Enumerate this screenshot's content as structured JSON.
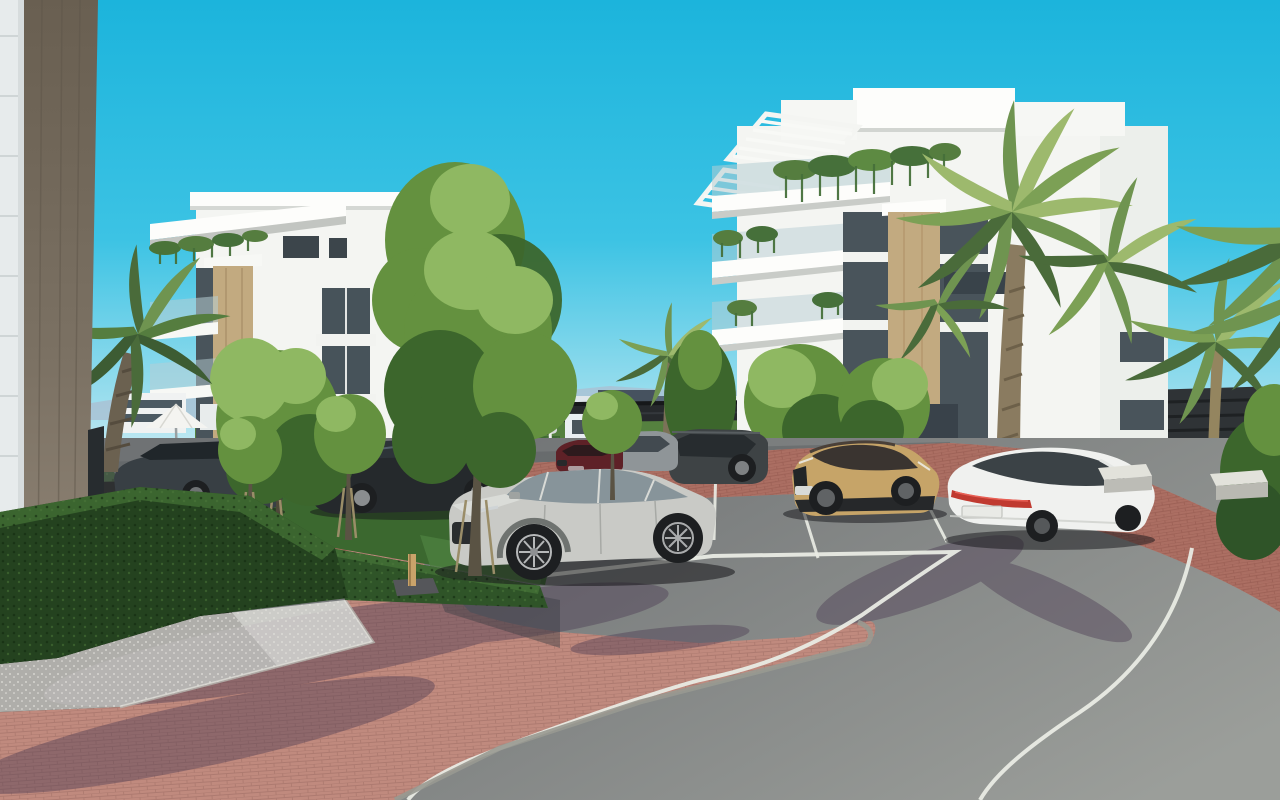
{
  "meta": {
    "type": "3d-architectural-render",
    "subject": "Modern white apartment complex with landscaped parking area, palm trees and curving access road under a clear cyan sky"
  },
  "palette": {
    "sky_top": "#1cb4dc",
    "sky_upper": "#3cc3e4",
    "sky_pale": "#9fdfee",
    "sky_horizon": "#dcf1f6",
    "mountain": "#a9c2d3",
    "town_white": "#e9eef1",
    "town_dark": "#46525f",
    "town_beige": "#cfc6b2",
    "fence": "#26292c",
    "wall_panel": "#e7ebec",
    "wall_brown": "#7a7063",
    "building_white": "#f4f5f2",
    "building_shade": "#e3e6e2",
    "cladding_tan": "#c2aa80",
    "glass_dark": "#49545b",
    "balustrade_glass": "#b7cdd3",
    "leaf_light": "#8fb862",
    "leaf_mid": "#64913f",
    "leaf_dark": "#3c662c",
    "palm_light": "#9db96d",
    "palm_mid": "#6f9450",
    "palm_dark": "#4a6b3a",
    "palm_trunk": "#8a7b60",
    "hedge_dark": "#24421f",
    "hedge_mid": "#2f5428",
    "hedge_light": "#3f6b33",
    "lawn": "#3b682f",
    "grass_sun": "#679553",
    "asphalt_dark": "#6f7274",
    "asphalt_light": "#9b9e9a",
    "paver_plaza": "#c08a7e",
    "paver_walkway": "#a86a5e",
    "gravel": "#e9e8e3",
    "marking_white": "#e9ebe4",
    "curb_grey": "#989991",
    "car_silver": "#c9cac6",
    "car_black": "#25292c",
    "car_estate_grey": "#383f44",
    "car_red": "#5e2127",
    "car_grey_suv": "#8f9598",
    "car_dark_suv": "#3e4345",
    "car_gold": "#c6a468",
    "car_white": "#f0f1ef",
    "car_distant": "#d8dbdb",
    "taillight_red": "#c03a30",
    "wheel_dark": "#1d1f21",
    "stake_wood": "#c9a36a",
    "umbrella_white": "#f4f4f1",
    "bench_concrete": "#e2e2db"
  },
  "scene": {
    "buildings": [
      {
        "id": "left-apartment-building",
        "floors": 4,
        "style": "white modern with tan cladding strip, cantilevered roof terrace and hanging plants"
      },
      {
        "id": "right-apartment-building",
        "floors": 4,
        "style": "white modern with rooftop pergolas, glass balconies, trailing greenery and tan cladding strip"
      },
      {
        "id": "foreground-wall",
        "style": "brown concrete column and white panel wall at left edge"
      },
      {
        "id": "distant-town",
        "style": "low white and dark buildings beyond perimeter fence with mountains on horizon"
      }
    ],
    "vehicles": [
      {
        "id": "silver-suv",
        "position": "center foreground parking stall"
      },
      {
        "id": "black-estate",
        "position": "behind trees, left row"
      },
      {
        "id": "dark-grey-estate",
        "position": "far left behind hedge"
      },
      {
        "id": "dark-red-suv",
        "position": "back row center"
      },
      {
        "id": "grey-suv",
        "position": "back row center"
      },
      {
        "id": "dark-suv",
        "position": "back row right of center"
      },
      {
        "id": "gold-crossover",
        "position": "right stalls facing viewer"
      },
      {
        "id": "white-fastback-sedan",
        "position": "right stalls, rear view"
      },
      {
        "id": "distant-white-car",
        "position": "on internal road behind hedge"
      }
    ],
    "landscape": [
      "palm-trees",
      "deciduous-trees",
      "sapling-trees-with-stakes",
      "boxwood-hedges",
      "lawns"
    ],
    "ground": [
      "brick-paver-plaza-island",
      "brick-walkway",
      "asphalt-parking-stalls",
      "curving-asphalt-road",
      "white-gravel-bed",
      "white-road-markings",
      "grey-curbs"
    ],
    "props": [
      "white-parasol",
      "sun-loungers",
      "dark-slatted-gate",
      "wooden-tree-stake",
      "concrete-benches",
      "white-lamp-post"
    ]
  }
}
